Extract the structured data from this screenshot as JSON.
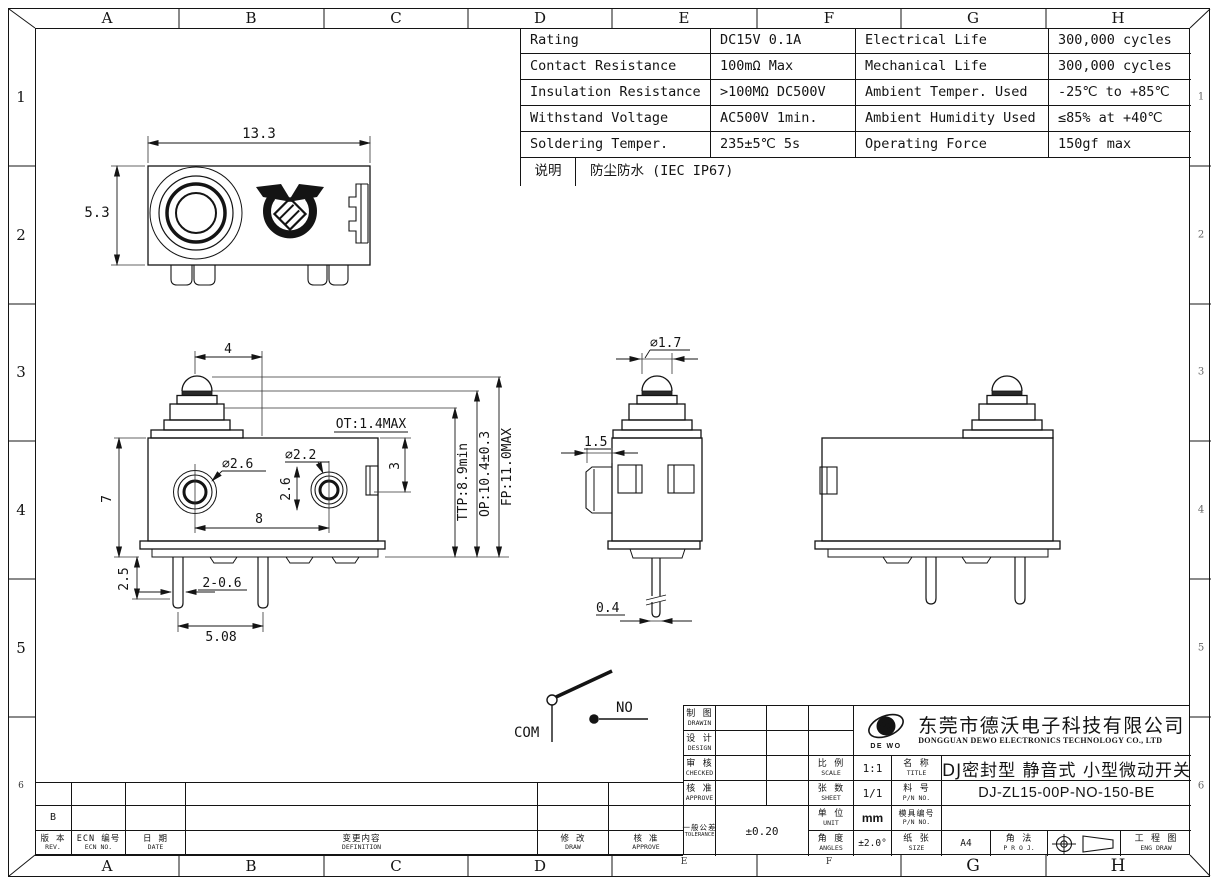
{
  "frame": {
    "cols": [
      "A",
      "B",
      "C",
      "D",
      "E",
      "F",
      "G",
      "H"
    ],
    "rows": [
      "1",
      "2",
      "3",
      "4",
      "5",
      "6"
    ]
  },
  "spec_table": {
    "rows": [
      {
        "p": "Rating",
        "pv": "DC15V 0.1A",
        "q": "Electrical Life",
        "qv": "300,000 cycles"
      },
      {
        "p": "Contact Resistance",
        "pv": "100mΩ Max",
        "q": "Mechanical Life",
        "qv": "300,000 cycles"
      },
      {
        "p": "Insulation Resistance",
        "pv": ">100MΩ DC500V",
        "q": "Ambient Temper. Used",
        "qv": "-25℃ to +85℃"
      },
      {
        "p": "Withstand Voltage",
        "pv": "AC500V 1min.",
        "q": "Ambient Humidity Used",
        "qv": "≤85% at +40℃"
      },
      {
        "p": "Soldering Temper.",
        "pv": "235±5℃ 5s",
        "q": "Operating Force",
        "qv": "150gf max"
      }
    ],
    "note_label": "说明",
    "note_value": "防尘防水 (IEC IP67)"
  },
  "views": {
    "top": {
      "width": "13.3",
      "height": "5.3"
    },
    "front": {
      "offset": "4",
      "ot": "OT:1.4MAX",
      "ttp": "TTP:8.9min",
      "op": "OP:10.4±0.3",
      "fp": "FP:11.0MAX",
      "dia_left": "⌀2.6",
      "dia_right": "⌀2.2",
      "right_h": "2.6",
      "step": "3",
      "height": "7",
      "spacing": "8",
      "tail": "2.5",
      "pin": "2-0.6",
      "pitch": "5.08"
    },
    "side": {
      "dia": "⌀1.7",
      "conn": "1.5",
      "pin": "0.4"
    }
  },
  "circuit": {
    "com": "COM",
    "no": "NO"
  },
  "revisions": {
    "rev_value": "B",
    "headers": [
      {
        "zh": "版 本",
        "en": "REV."
      },
      {
        "zh": "ECN 编号",
        "en": "ECN NO."
      },
      {
        "zh": "日 期",
        "en": "DATE"
      },
      {
        "zh": "变更内容",
        "en": "DEFINITION"
      },
      {
        "zh": "修 改",
        "en": "DRAW"
      },
      {
        "zh": "核 准",
        "en": "APPROVE"
      }
    ]
  },
  "title_block": {
    "drawin": {
      "zh": "制 图",
      "en": "DRAWIN"
    },
    "design": {
      "zh": "设 计",
      "en": "DESIGN"
    },
    "checked": {
      "zh": "审 核",
      "en": "CHECKED"
    },
    "approve": {
      "zh": "核 准",
      "en": "APPROVE"
    },
    "tolerance": {
      "zh": "一般公差",
      "en": "TOLERANCE",
      "value": "±0.20"
    },
    "scale": {
      "zh": "比 例",
      "en": "SCALE",
      "value": "1:1"
    },
    "sheet": {
      "zh": "张 数",
      "en": "SHEET",
      "value": "1/1"
    },
    "unit": {
      "zh": "单 位",
      "en": "UNIT",
      "value": "mm"
    },
    "angles": {
      "zh": "角 度",
      "en": "ANGLES",
      "value": "±2.0°"
    },
    "name": {
      "zh": "名 称",
      "en": "TITLE",
      "value": "DJ密封型 静音式 小型微动开关"
    },
    "part_no": {
      "zh": "料 号",
      "en": "P/N NO.",
      "value": "DJ-ZL15-00P-NO-150-BE"
    },
    "mold_no": {
      "zh": "模具编号",
      "en": "P/N NO."
    },
    "paper": {
      "zh": "纸 张",
      "en": "SIZE",
      "value": "A4"
    },
    "projection": {
      "zh": "角 法",
      "en": "P R O J."
    },
    "eng_draw": {
      "zh": "工 程 图",
      "en": "ENG DRAW"
    },
    "company": {
      "logo": "DE WO",
      "logo_letter": "W",
      "zh": "东莞市德沃电子科技有限公司",
      "en": "DONGGUAN DEWO ELECTRONICS TECHNOLOGY CO., LTD"
    }
  }
}
